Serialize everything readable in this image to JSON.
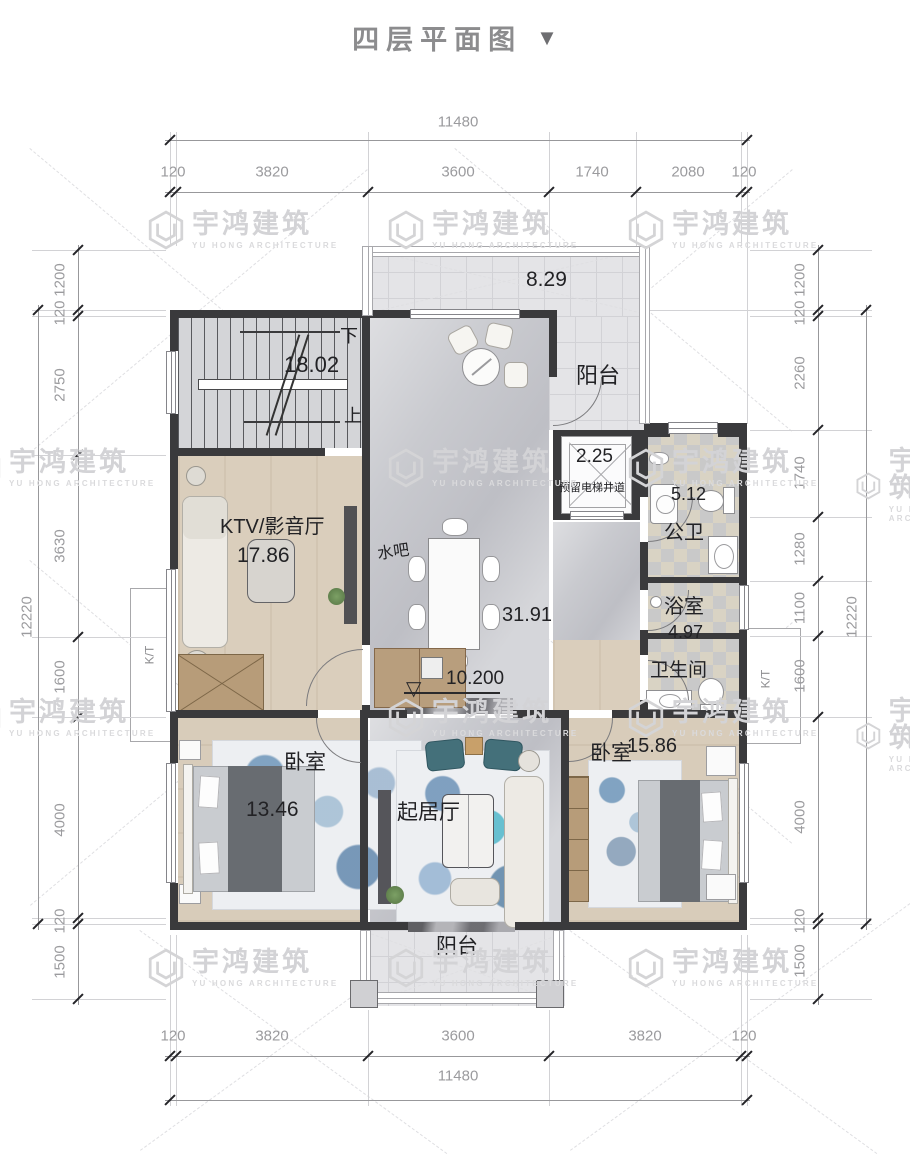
{
  "title": {
    "text": "四层平面图",
    "arrow": "▼"
  },
  "watermark": {
    "cn": "宇鸿建筑",
    "en": "YU HONG ARCHITECTURE"
  },
  "dims": {
    "top": {
      "total": "11480",
      "segments": [
        "120",
        "3820",
        "3600",
        "1740",
        "2080",
        "120"
      ]
    },
    "bottom": {
      "total": "11480",
      "segments": [
        "120",
        "3820",
        "3600",
        "3820",
        "120"
      ]
    },
    "left": {
      "total": "12220",
      "segments": [
        "1200",
        "120",
        "2750",
        "3630",
        "1600",
        "4000",
        "120",
        "1500"
      ]
    },
    "right": {
      "total": "12220",
      "segments": [
        "1200",
        "120",
        "2260",
        "1740",
        "1280",
        "1100",
        "1600",
        "4000",
        "120",
        "1500"
      ]
    }
  },
  "rooms": {
    "balcony_top": {
      "label": "阳台",
      "area": "8.29"
    },
    "stair": {
      "area": "18.02",
      "down": "下",
      "up": "上"
    },
    "elevator": {
      "area": "2.25",
      "label": "预留电梯井道"
    },
    "public_wc": {
      "label": "公卫",
      "area": "5.12"
    },
    "ktv": {
      "label": "KTV/影音厅",
      "area": "17.86"
    },
    "water_bar": {
      "label": "水吧"
    },
    "hall": {
      "area": "31.91",
      "elevation": "10.200"
    },
    "bath": {
      "label": "浴室",
      "area": "4.97"
    },
    "toilet": {
      "label": "卫生间"
    },
    "bedroom_left": {
      "label": "卧室",
      "area": "13.46"
    },
    "living": {
      "label": "起居厅"
    },
    "bedroom_right": {
      "label": "卧室",
      "area": "15.86"
    },
    "balcony_bottom": {
      "label": "阳台"
    },
    "bay_window_left": {
      "label": "K/T"
    },
    "bay_window_right": {
      "label": "K/T"
    }
  }
}
